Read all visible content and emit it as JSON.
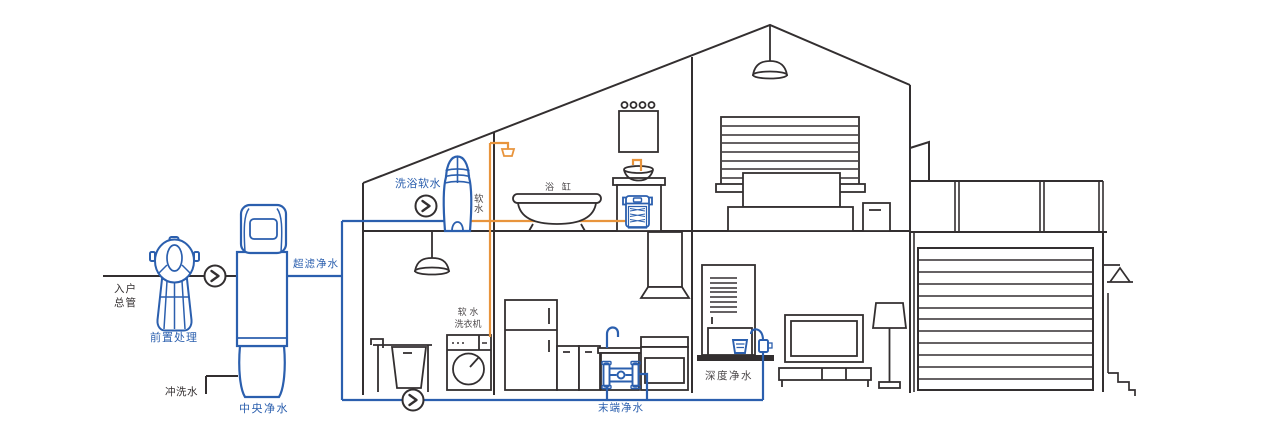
{
  "labels": {
    "inlet_main": "入户\n总管",
    "pre_treatment": "前置处理",
    "central_purification": "中央净水",
    "flush_water": "冲洗水",
    "ultrafiltration": "超滤净水",
    "bath_soft_water": "洗浴软水",
    "soft_water": "软\n水",
    "bathtub": "浴 缸",
    "soft_water_washer": "软 水\n洗衣机",
    "terminal_purification": "末端净水",
    "deep_purification": "深度净水"
  },
  "icons": {
    "flow_arrow": "chevron-right-in-circle"
  },
  "colors": {
    "outline_dark": "#332f30",
    "label_gray": "#4b4749",
    "device_blue": "#2b5fae",
    "pipe_orange": "#e8943c"
  }
}
